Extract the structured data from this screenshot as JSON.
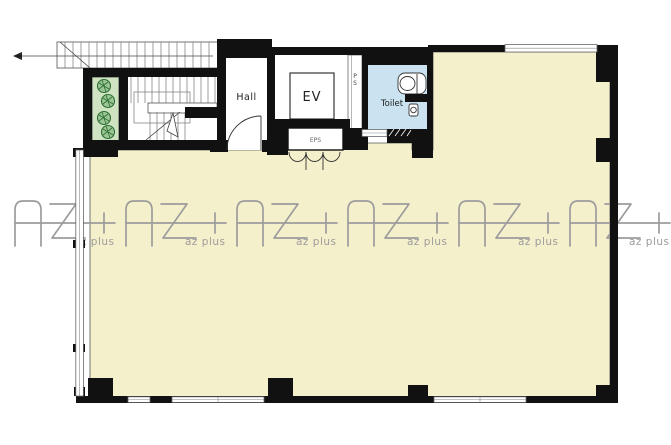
{
  "meta": {
    "type": "architectural floor plan"
  },
  "colors": {
    "background": "#ffffff",
    "wall": "#111111",
    "floor": "#f5f0cc",
    "toilet_floor": "#cbe3f1",
    "planter": "#cfe3c3",
    "plant_symbol": "#2c6e33",
    "watermark": "#9c9c9c",
    "line": "#444444"
  },
  "rooms": {
    "hall": {
      "label": "Hall"
    },
    "elevator": {
      "label": "EV"
    },
    "eps": {
      "label": "EPS"
    },
    "ps": {
      "label": "PS"
    },
    "toilet": {
      "label": "Toilet"
    }
  },
  "watermark": {
    "brand": "AZ+",
    "sub_label": "az plus",
    "repetitions": 6
  }
}
